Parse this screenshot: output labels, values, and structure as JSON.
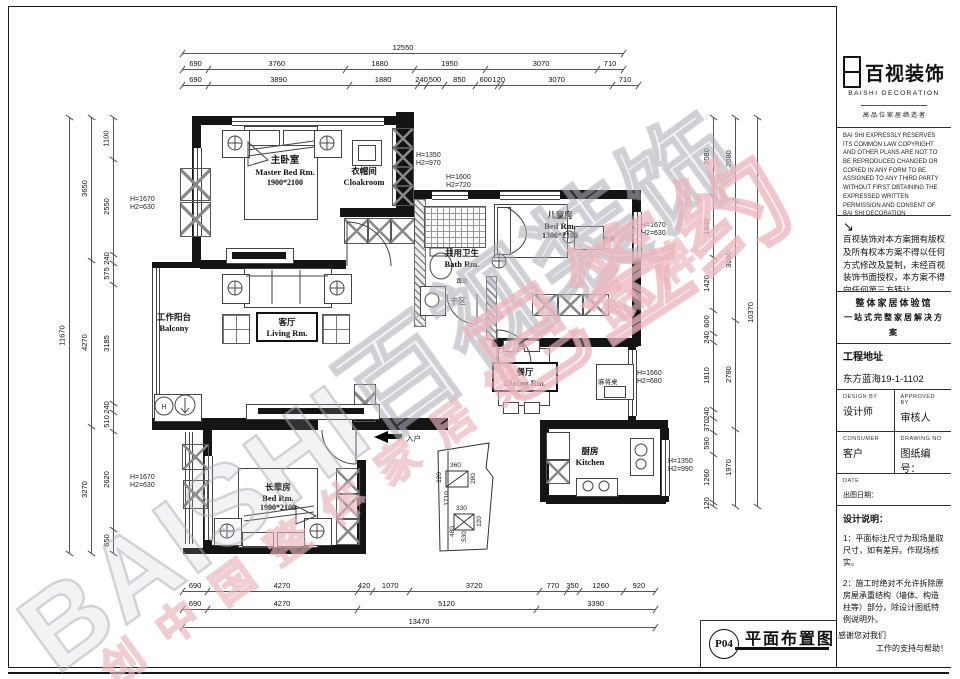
{
  "watermark": {
    "main": "BAISHI百视装饰",
    "slogan": "创中国整体家居第一品牌",
    "badge": "已签约"
  },
  "dims": {
    "top_overall": "12550",
    "top_row2": [
      "690",
      "3760",
      "1880",
      "1950",
      "3070",
      "710"
    ],
    "top_row3": [
      "690",
      "3890",
      "1880",
      "240",
      "500",
      "850",
      "600",
      "120",
      "3070",
      "710"
    ],
    "bottom_row1": [
      "690",
      "4270",
      "420",
      "1070",
      "3720",
      "770",
      "350",
      "1260",
      "920"
    ],
    "bottom_row2": [
      "690",
      "4270",
      "5120",
      "3390"
    ],
    "bottom_overall": "13470",
    "left_outer": [
      "11670"
    ],
    "left_mid": [
      "3650",
      "4270",
      "3270"
    ],
    "left_inner": [
      "1100",
      "2550",
      "240",
      "575",
      "3185",
      "240",
      "510",
      "2620",
      "650"
    ],
    "right_outer": [
      "10370"
    ],
    "right_mid": [
      "2080",
      "3060",
      "2780",
      "1970"
    ],
    "right_inner": [
      "2080",
      "1640",
      "1420",
      "600",
      "240",
      "1810",
      "240",
      "370",
      "590",
      "1260",
      "120"
    ],
    "detail": [
      "360",
      "120",
      "280",
      "330",
      "120",
      "1710",
      "480",
      "530"
    ]
  },
  "rooms": {
    "master": {
      "zh": "主卧室",
      "en": "Master Bed Rm.",
      "size": "1900*2100"
    },
    "cloak": {
      "zh": "衣帽间",
      "en": "Cloakroom"
    },
    "kids": {
      "zh": "儿童房",
      "en": "Bed Rm.",
      "size": "1300*2100"
    },
    "desk": {
      "zh": "书桌"
    },
    "bath": {
      "zh": "共用卫生",
      "en": "Bath Rm.",
      "note": "蹲坑"
    },
    "dry": {
      "zh": "干区"
    },
    "living": {
      "zh": "客厅",
      "en": "Living Rm."
    },
    "balcony": {
      "zh": "工作阳台",
      "en": "Balcony"
    },
    "dining": {
      "zh": "餐厅",
      "en": "Dining Rm."
    },
    "mahjong": {
      "zh": "麻将桌"
    },
    "kitchen": {
      "zh": "厨房",
      "en": "Kitchen"
    },
    "elder": {
      "zh": "长辈房",
      "en": "Bed Rm.",
      "size": "1900*2100"
    },
    "entry": {
      "zh": "入户"
    }
  },
  "plan": {
    "washer_label": "H"
  },
  "heights": [
    {
      "l1": "H=1670",
      "l2": "H2=630"
    },
    {
      "l1": "H=1350",
      "l2": "H2=970"
    },
    {
      "l1": "H=1600",
      "l2": "H2=720"
    },
    {
      "l1": "H=1670",
      "l2": "H2=630"
    },
    {
      "l1": "H=1660",
      "l2": "H2=680"
    },
    {
      "l1": "H=1350",
      "l2": "H2=990"
    },
    {
      "l1": "H=1670",
      "l2": "H2=630"
    }
  ],
  "sidebar": {
    "logo": {
      "zh": "百视装饰",
      "en": "BAISHI DECORATION",
      "tagline": "·高·品·位·家·居·缔·造·者·"
    },
    "legal_en": "BAI SHI EXPRESSLY RESERVES ITS COMMON LAW COPYRIGHT AND OTHER PLANS ARE NOT TO BE REPRODUCED CHANGED OR COPIED IN ANY FORM TO BE ASSIGNED TO ANY THIRD PARTY WITHOUT FIRST OBTAINING THE EXPRESSED WRITTEN PERMISSION AND CONSENT OF BAI SHI DECORATION",
    "legal_arrow": "↘",
    "legal_zh": "百视装饰对本方案拥有版权及所有权本方案不得以任何方式修改及复制，未经百视装饰书面授权，本方案不得向任何第三方转让。",
    "slogan1": "整体家居体验馆",
    "slogan2": "一站式完整家居解决方案",
    "address_label": "工程地址",
    "address": "东方蓝海19-1-1102",
    "design_by_en": "DESIGN BY",
    "design_by": "设计师",
    "approved_en": "APPROVED BY",
    "approved": "审核人",
    "consumer_en": "CONSUMER",
    "consumer": "客户",
    "drawing_en": "DRAWING NO",
    "drawing": "图纸编号：",
    "date_en": "DATE",
    "date": "出图日期：",
    "notes_title": "设计说明：",
    "notes": [
      "1：平面标注尺寸为现场量取尺寸，如有差异。作现场核实。",
      "2：施工时绝对不允许拆除原房屋承重结构（墙体、构造柱等）部分，除设计图纸特例说明外。",
      "3：该图纸为施工图纸，双方（设计和甲方）签字认可后，方可作为施工依据。"
    ],
    "thanks1": "感谢您对我们",
    "thanks2": "工作的支持与帮助！"
  },
  "titleblock": {
    "code": "P04",
    "title": "平面布置图"
  }
}
